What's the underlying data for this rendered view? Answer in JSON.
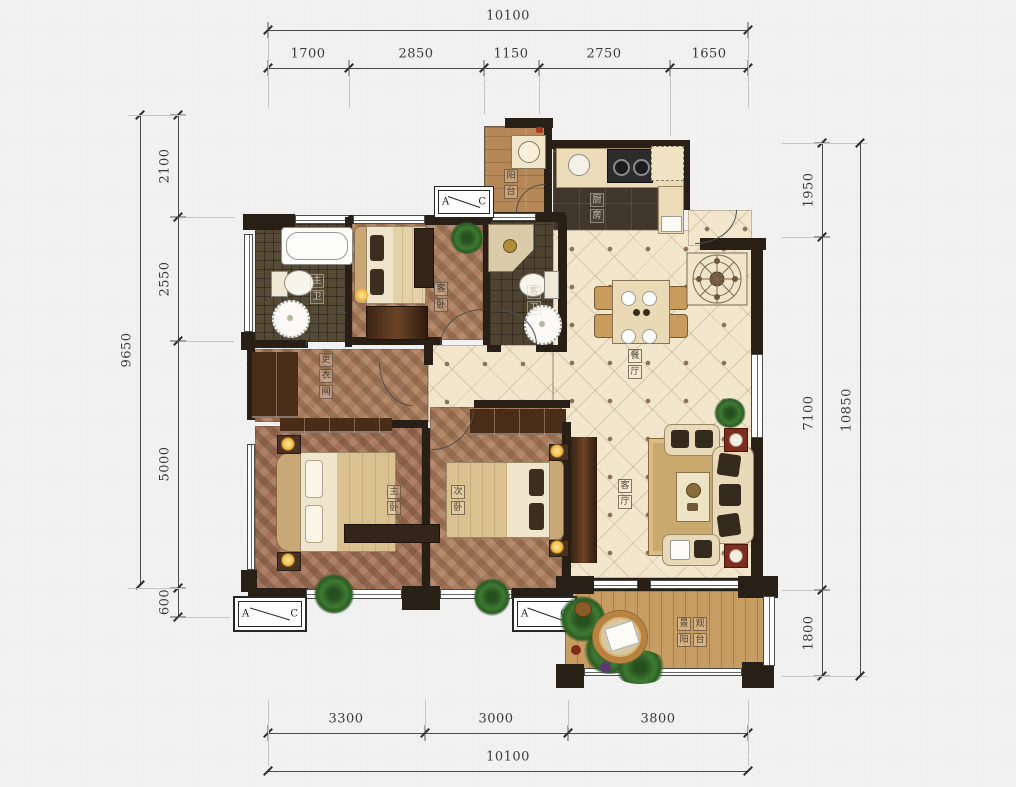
{
  "dimensions": {
    "top": {
      "total": "10100",
      "segments": [
        "1700",
        "2850",
        "1150",
        "2750",
        "1650"
      ]
    },
    "bottom": {
      "total": "10100",
      "segments": [
        "3300",
        "3000",
        "3800"
      ]
    },
    "left": {
      "total": "9650",
      "segments": [
        "2100",
        "2550",
        "5000",
        "600"
      ]
    },
    "right": {
      "total": "10850",
      "segments": [
        "1950",
        "7100",
        "1800"
      ]
    }
  },
  "rooms": {
    "balcony_top": "阳台",
    "kitchen": "厨房",
    "dining": "餐厅",
    "living": "客厅",
    "master_bedroom": "主卧",
    "second_bedroom": "次卧",
    "guest_bedroom": "客卧",
    "master_bath": "主卫",
    "guest_bath": "客卫",
    "dressing": "更衣间",
    "view_balcony": "景观阳台"
  },
  "section_marker": {
    "a": "A",
    "c": "C"
  },
  "colors": {
    "wall": "#281f17",
    "tile_floor": "#f2e7cd",
    "wood_floor": "#a97d5e",
    "kitchen_tile": "#40362c",
    "balcony_wood": "#c89d64",
    "accent_red": "#7e2d1c",
    "lamp_glow": "#f2b93e",
    "plant_green": "#3e7a33"
  }
}
